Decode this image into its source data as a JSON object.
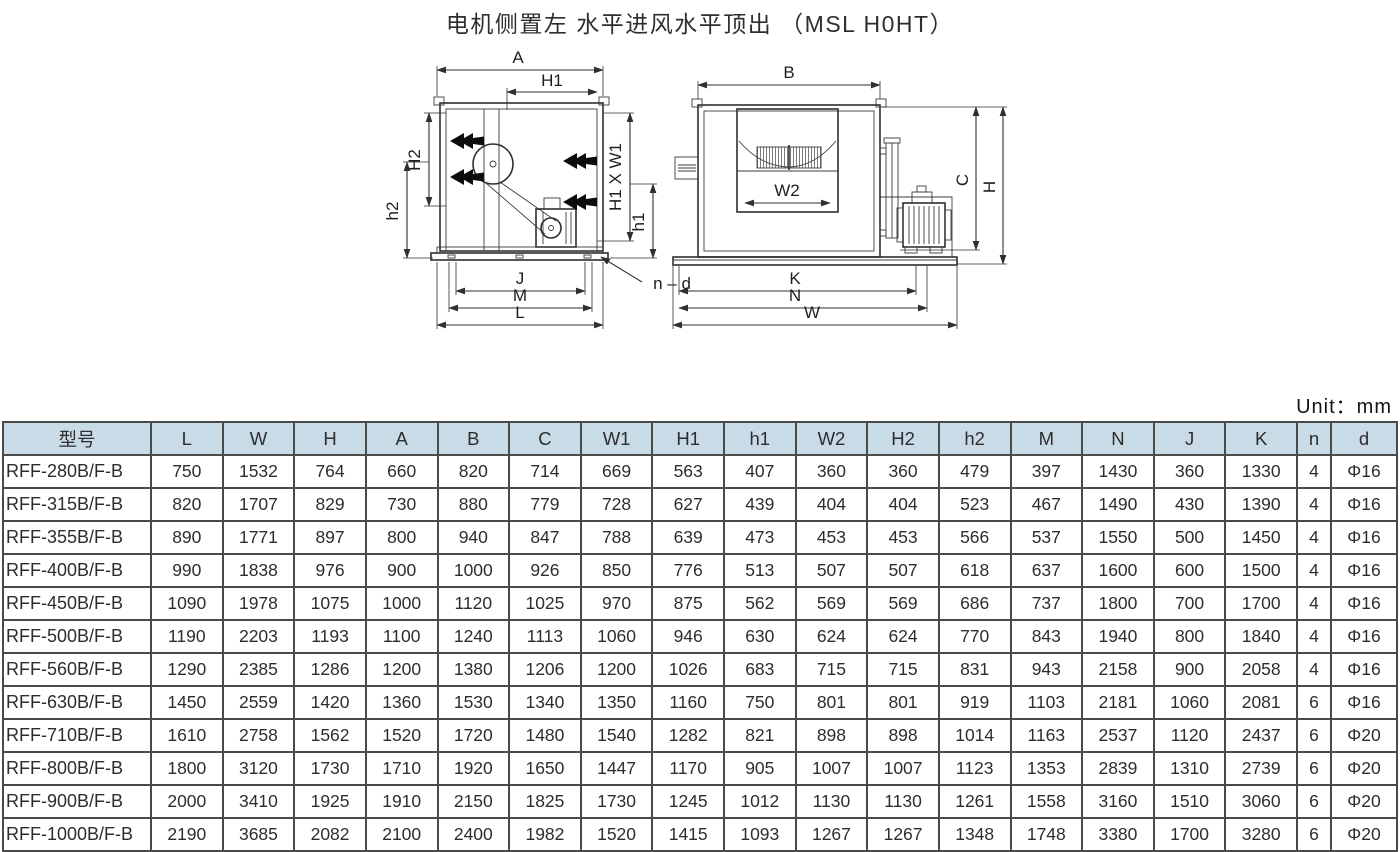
{
  "title": "电机侧置左 水平进风水平顶出 （MSL H0HT）",
  "unit_label": "Unit：mm",
  "colors": {
    "header_bg": "#c9dbe7",
    "border": "#4a4a4a",
    "line_art": "#2f2f2f"
  },
  "diagrams": {
    "left": {
      "labels": {
        "a": "A",
        "h1_top": "H1",
        "h2_side": "H2",
        "h2_small": "h2",
        "opening": "H1 X W1",
        "h1_small": "h1",
        "j": "J",
        "m": "M",
        "l": "L",
        "nd": "n – d"
      }
    },
    "right": {
      "labels": {
        "b": "B",
        "c": "C",
        "h": "H",
        "w2": "W2",
        "k": "K",
        "n": "N",
        "w": "W"
      }
    }
  },
  "table": {
    "columns": [
      "型号",
      "L",
      "W",
      "H",
      "A",
      "B",
      "C",
      "W1",
      "H1",
      "h1",
      "W2",
      "H2",
      "h2",
      "M",
      "N",
      "J",
      "K",
      "n",
      "d"
    ],
    "rows": [
      [
        "RFF-280B/F-B",
        750,
        1532,
        764,
        660,
        820,
        714,
        669,
        563,
        407,
        360,
        360,
        479,
        397,
        1430,
        360,
        1330,
        4,
        "Φ16"
      ],
      [
        "RFF-315B/F-B",
        820,
        1707,
        829,
        730,
        880,
        779,
        728,
        627,
        439,
        404,
        404,
        523,
        467,
        1490,
        430,
        1390,
        4,
        "Φ16"
      ],
      [
        "RFF-355B/F-B",
        890,
        1771,
        897,
        800,
        940,
        847,
        788,
        639,
        473,
        453,
        453,
        566,
        537,
        1550,
        500,
        1450,
        4,
        "Φ16"
      ],
      [
        "RFF-400B/F-B",
        990,
        1838,
        976,
        900,
        1000,
        926,
        850,
        776,
        513,
        507,
        507,
        618,
        637,
        1600,
        600,
        1500,
        4,
        "Φ16"
      ],
      [
        "RFF-450B/F-B",
        1090,
        1978,
        1075,
        1000,
        1120,
        1025,
        970,
        875,
        562,
        569,
        569,
        686,
        737,
        1800,
        700,
        1700,
        4,
        "Φ16"
      ],
      [
        "RFF-500B/F-B",
        1190,
        2203,
        1193,
        1100,
        1240,
        1113,
        1060,
        946,
        630,
        624,
        624,
        770,
        843,
        1940,
        800,
        1840,
        4,
        "Φ16"
      ],
      [
        "RFF-560B/F-B",
        1290,
        2385,
        1286,
        1200,
        1380,
        1206,
        1200,
        1026,
        683,
        715,
        715,
        831,
        943,
        2158,
        900,
        2058,
        4,
        "Φ16"
      ],
      [
        "RFF-630B/F-B",
        1450,
        2559,
        1420,
        1360,
        1530,
        1340,
        1350,
        1160,
        750,
        801,
        801,
        919,
        1103,
        2181,
        1060,
        2081,
        6,
        "Φ16"
      ],
      [
        "RFF-710B/F-B",
        1610,
        2758,
        1562,
        1520,
        1720,
        1480,
        1540,
        1282,
        821,
        898,
        898,
        1014,
        1163,
        2537,
        1120,
        2437,
        6,
        "Φ20"
      ],
      [
        "RFF-800B/F-B",
        1800,
        3120,
        1730,
        1710,
        1920,
        1650,
        1447,
        1170,
        905,
        1007,
        1007,
        1123,
        1353,
        2839,
        1310,
        2739,
        6,
        "Φ20"
      ],
      [
        "RFF-900B/F-B",
        2000,
        3410,
        1925,
        1910,
        2150,
        1825,
        1730,
        1245,
        1012,
        1130,
        1130,
        1261,
        1558,
        3160,
        1510,
        3060,
        6,
        "Φ20"
      ],
      [
        "RFF-1000B/F-B",
        2190,
        3685,
        2082,
        2100,
        2400,
        1982,
        1520,
        1415,
        1093,
        1267,
        1267,
        1348,
        1748,
        3380,
        1700,
        3280,
        6,
        "Φ20"
      ]
    ]
  }
}
